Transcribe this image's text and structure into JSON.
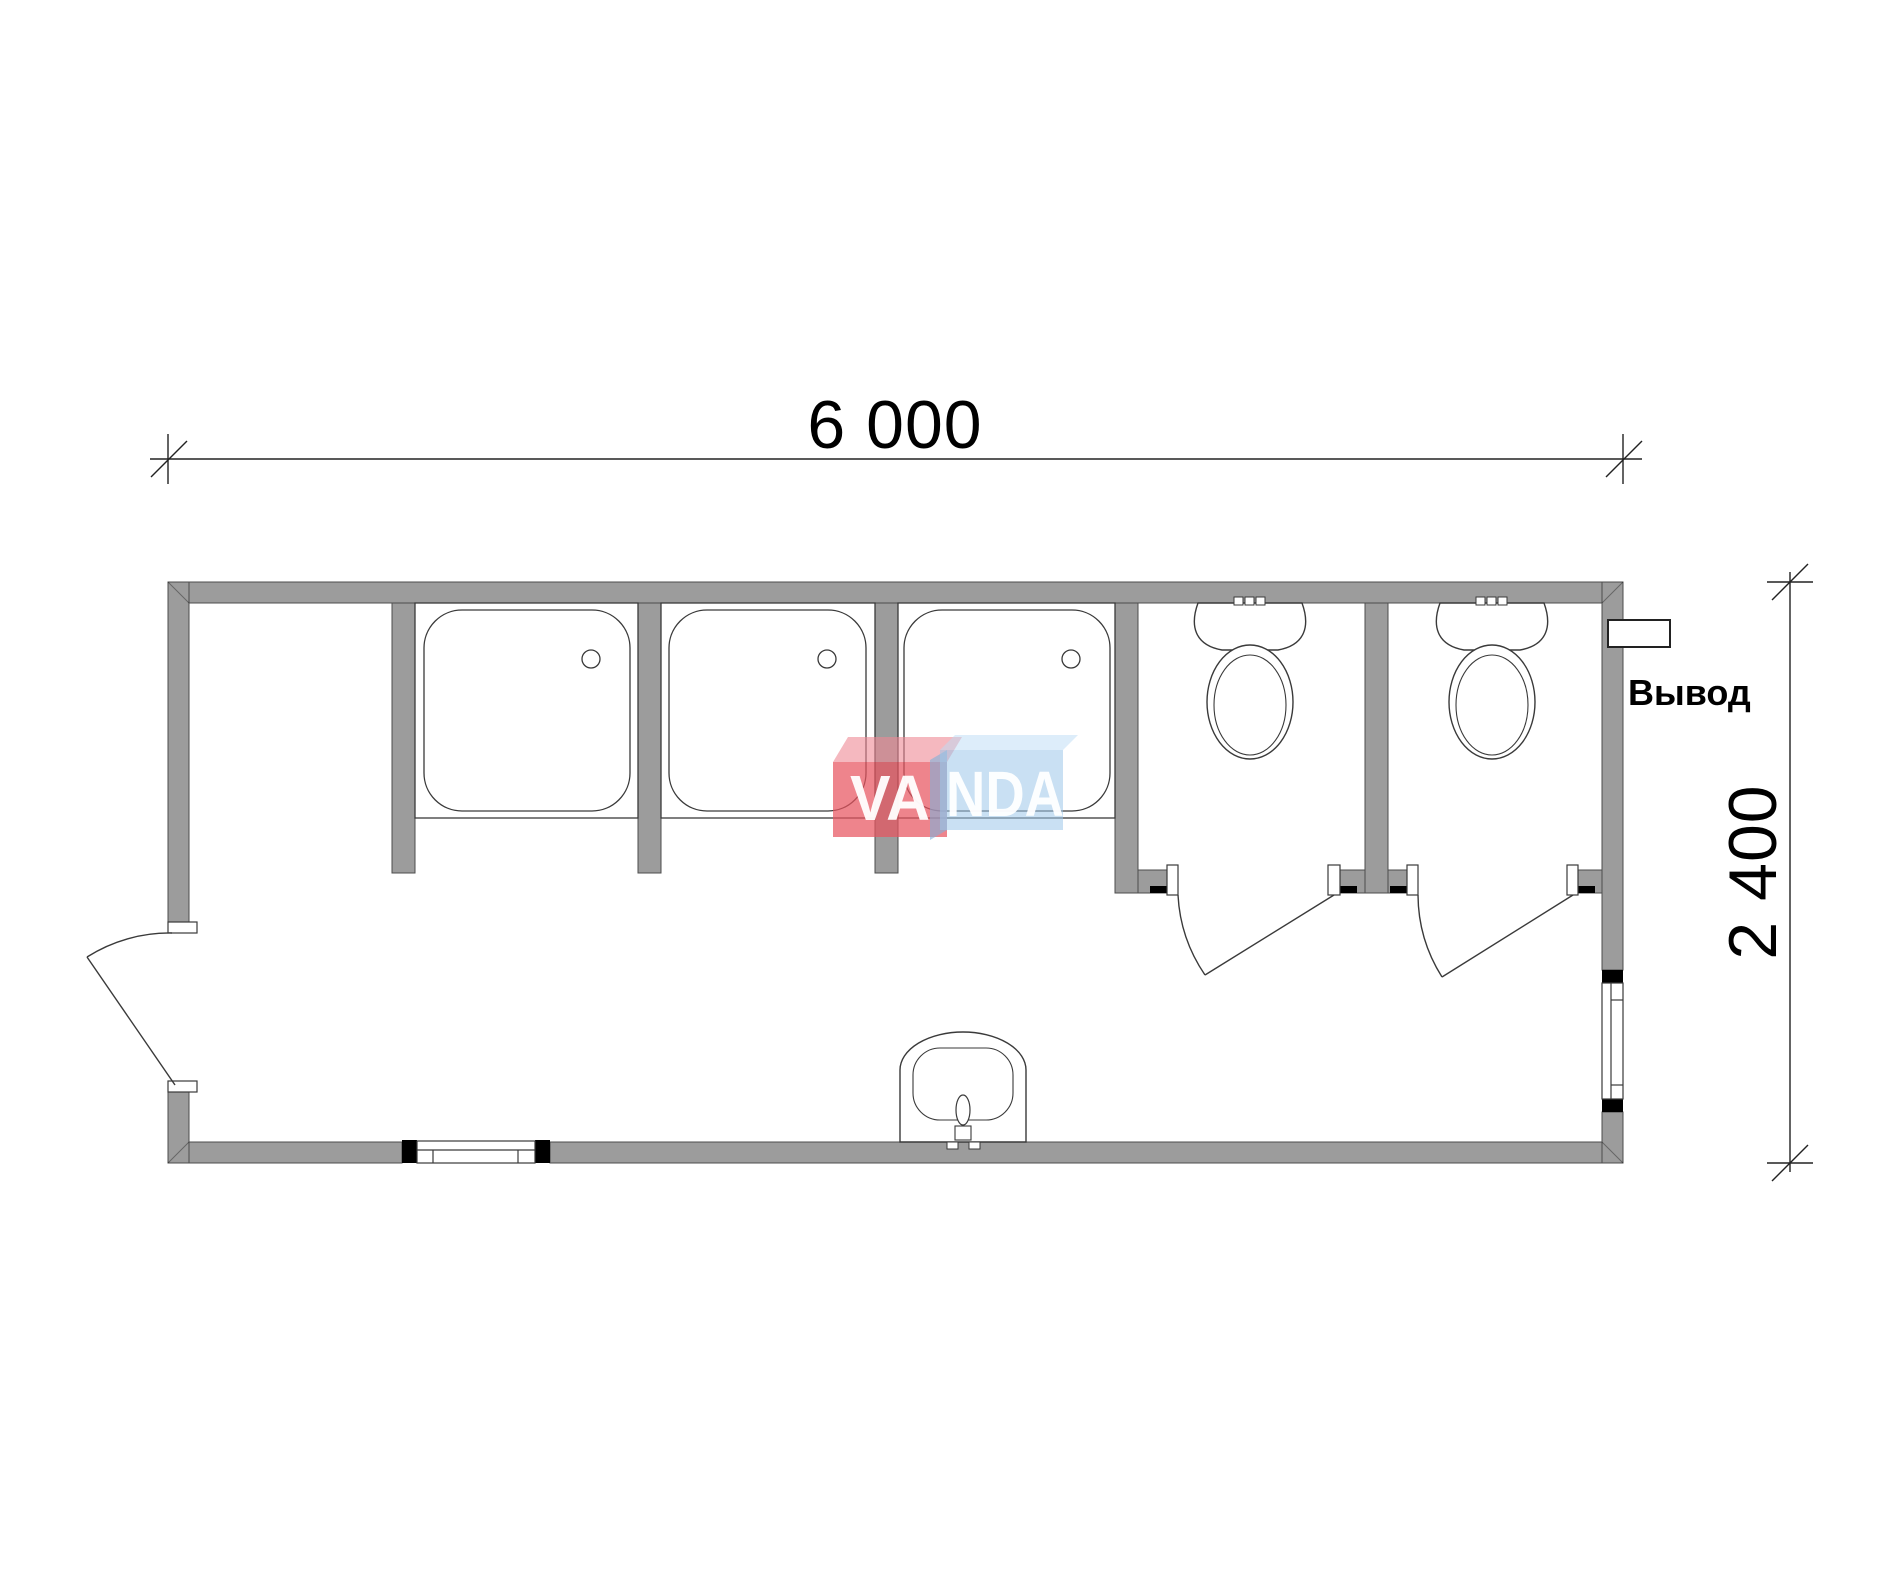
{
  "title": "Sanitary module floor plan",
  "dimensions": {
    "width_label": "6 000",
    "height_label": "2 400",
    "width_mm": 6000,
    "height_mm": 2400
  },
  "labels": {
    "outlet": "Вывод"
  },
  "logo": {
    "left_text": "VA",
    "right_text": "NDA"
  },
  "fixtures": {
    "shower_cabins": 3,
    "toilet_stalls": 2,
    "washbasins": 1,
    "doors": 3,
    "windows": 2,
    "outlets": 1
  },
  "colors": {
    "background": "#ffffff",
    "wall": "#9c9c9c",
    "wall_outline": "#4d4d4d",
    "line": "#3a3a3a",
    "dim_line": "#222222",
    "black": "#000000",
    "logo_red_front": "#e85560",
    "logo_red_top": "#ef8894",
    "logo_blue_front": "#9cc6e9",
    "logo_blue_top": "#bcdcf5",
    "logo_blue_side": "#7fb0da",
    "logo_text": "#ffffff"
  }
}
